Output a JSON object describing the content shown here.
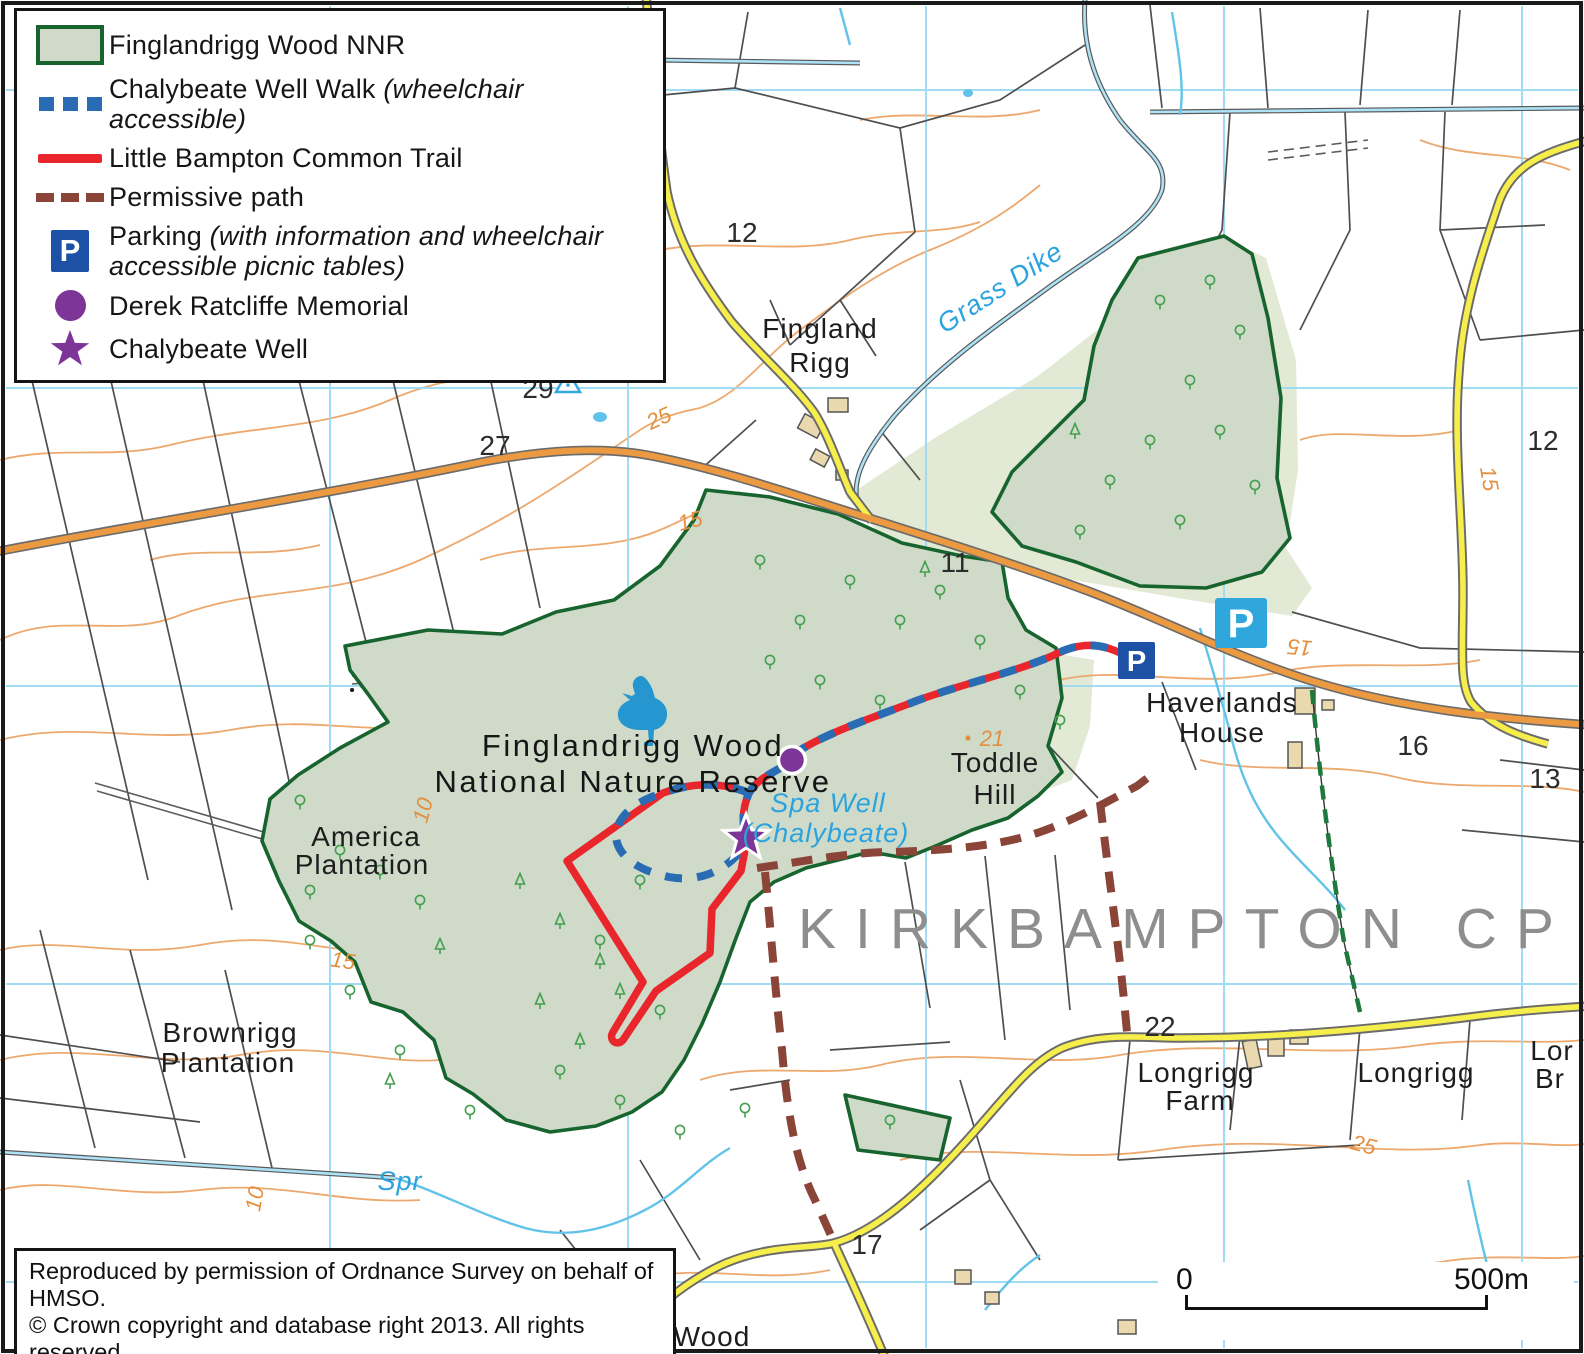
{
  "legend": {
    "items": [
      {
        "label": "Finglandrigg Wood NNR"
      },
      {
        "label": "Chalybeate Well Walk",
        "note": "(wheelchair accessible)"
      },
      {
        "label": "Little Bampton Common Trail"
      },
      {
        "label": "Permissive path"
      },
      {
        "label": "Parking",
        "note": "(with information and wheelchair",
        "note2": "accessible picnic tables)"
      },
      {
        "label": "Derek Ratcliffe Memorial"
      },
      {
        "label": "Chalybeate Well"
      }
    ]
  },
  "attribution": {
    "line1": "Reproduced by permission of Ordnance Survey on behalf of HMSO.",
    "line2": "© Crown copyright and database right 2013.  All rights reserved.",
    "line3_left": "Natural England",
    "line3_right": "OS licence number 100022021"
  },
  "scalebar": {
    "zero": "0",
    "max": "500m"
  },
  "markers": {
    "parking_letter": "P"
  },
  "map_labels": {
    "fingland_rigg": {
      "line1": "Fingland",
      "line2": "Rigg"
    },
    "grass_dike": "Grass Dike",
    "nnr_name": {
      "line1": "Finglandrigg Wood",
      "line2": "National Nature Reserve"
    },
    "spa_well": {
      "line1": "Spa Well",
      "line2": "(Chalybeate)"
    },
    "toddle_hill": {
      "line1": "Toddle",
      "line2": "Hill"
    },
    "haverlands": {
      "line1": "Haverlands",
      "line2": "House"
    },
    "america": {
      "line1": "America",
      "line2": "Plantation"
    },
    "brownrigg": {
      "line1": "Brownrigg",
      "line2": "Plantation"
    },
    "longrigg_farm": {
      "line1": "Longrigg",
      "line2": "Farm"
    },
    "longrigg": "Longrigg",
    "longrigg_partial": {
      "line1": "Lor",
      "line2": "Br"
    },
    "kirkbampton": "KIRKBAMPTON CP",
    "spr": "Spr",
    "wood_partial": "Wood"
  },
  "numbers": {
    "field_12_top": "12",
    "height_29": "29",
    "height_27": "27",
    "field_11": "11",
    "field_12_right": "12",
    "field_16": "16",
    "field_13": "13",
    "field_22": "22",
    "field_17": "17",
    "spot_21": "21"
  },
  "contour_labels": {
    "c25": "25",
    "c15": "15",
    "c10": "10"
  },
  "colors": {
    "nnr-border": "#17642e",
    "nnr-fill": "#cfdac9",
    "wood-pale": "#e2e9d4",
    "marsh-tan": "#d8c59a",
    "clearing": "#efe9ad",
    "clearing-edge": "#e6c98f",
    "walk-blue": "#2a6cb3",
    "trail-red": "#e8262c",
    "perm-brown": "#8a4438",
    "parking-blue": "#1c51a5",
    "parking-light": "#2fa7dd",
    "purple": "#7d3597",
    "road-orange": "#ec9a42",
    "road-yellow": "#f6ee4b",
    "road-case": "#6b6b6b",
    "contour": "#eda86e",
    "grid-blue": "#9bdcf3",
    "stream-blue": "#62c3e8",
    "field-line": "#4f4f4f",
    "tree-green": "#44a04f",
    "water-text": "#2ba3df",
    "gray-text": "#8e8e8e",
    "fp-green": "#1d7a3c"
  }
}
